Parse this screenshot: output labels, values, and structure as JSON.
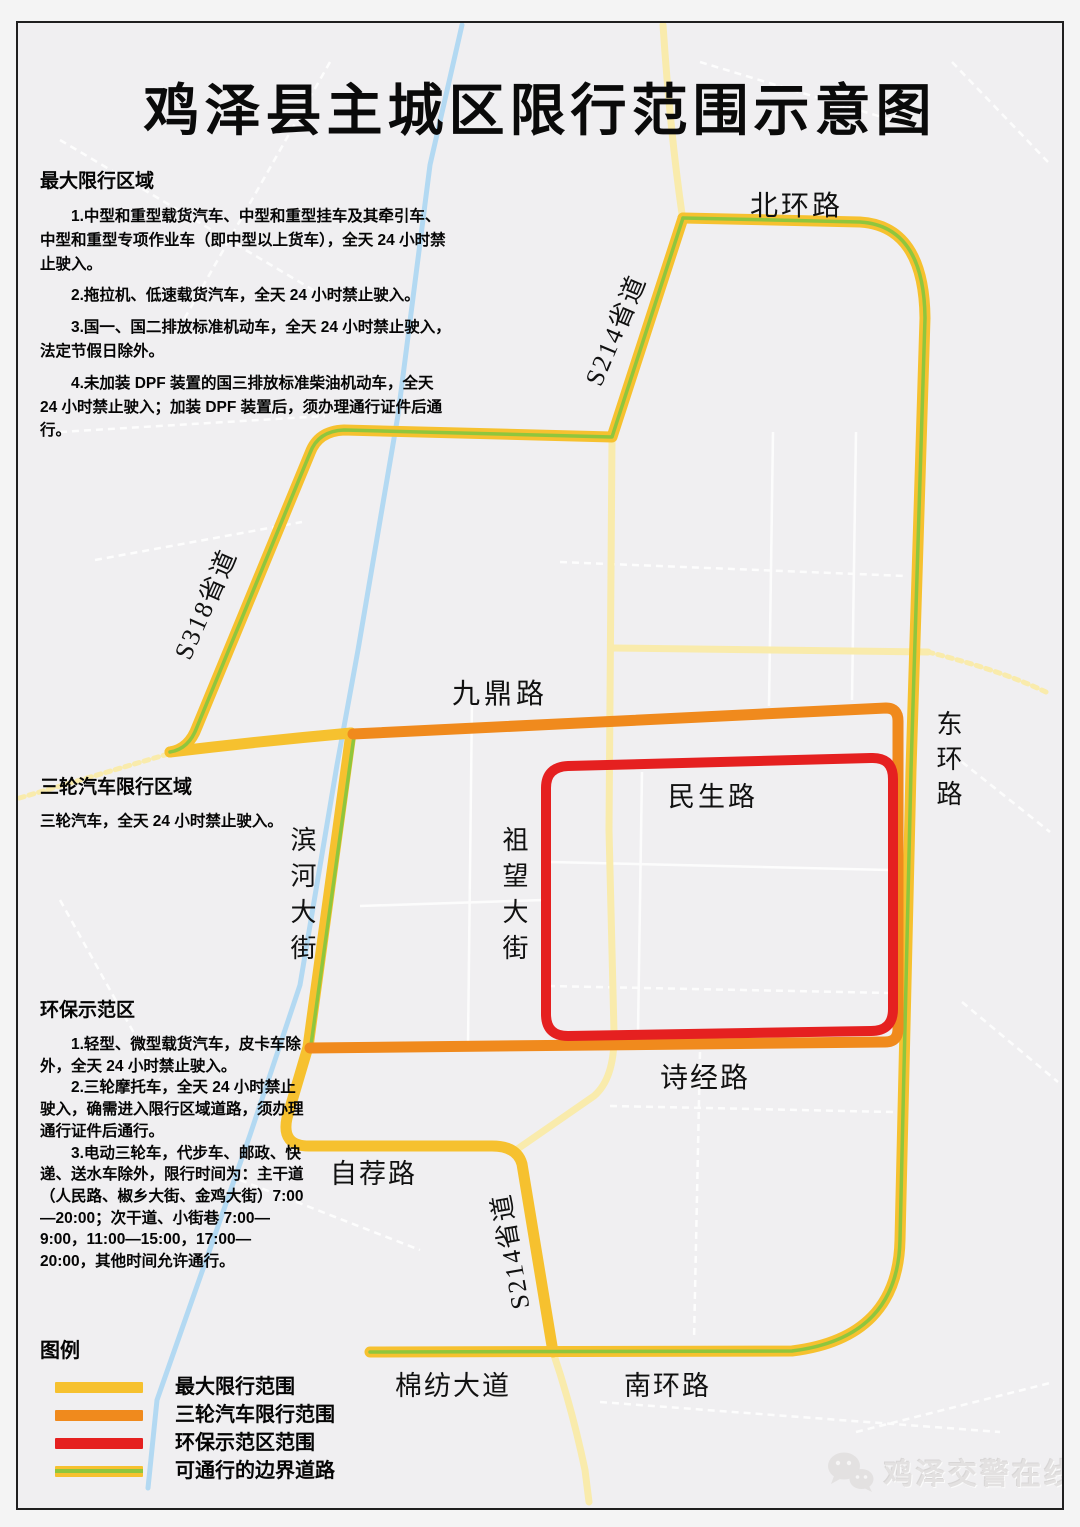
{
  "title": "鸡泽县主城区限行范围示意图",
  "sections": [
    {
      "heading": "最大限行区域",
      "paragraphs": [
        "1.中型和重型载货汽车、中型和重型挂车及其牵引车、中型和重型专项作业车（即中型以上货车），全天 24 小时禁止驶入。",
        "2.拖拉机、低速载货汽车，全天 24 小时禁止驶入。",
        "3.国一、国二排放标准机动车，全天 24 小时禁止驶入，法定节假日除外。",
        "4.未加装 DPF 装置的国三排放标准柴油机动车，全天 24 小时禁止驶入；加装 DPF 装置后，须办理通行证件后通行。"
      ]
    },
    {
      "heading": "三轮汽车限行区域",
      "paragraphs": [
        "三轮汽车，全天 24 小时禁止驶入。"
      ]
    },
    {
      "heading": "环保示范区",
      "paragraphs": [
        "1.轻型、微型载货汽车，皮卡车除外，全天 24 小时禁止驶入。",
        "2.三轮摩托车，全天 24 小时禁止驶入，确需进入限行区域道路，须办理通行证件后通行。",
        "3.电动三轮车，代步车、邮政、快递、送水车除外，限行时间为：主干道（人民路、椒乡大街、金鸡大街）7:00—20:00；次干道、小街巷 7:00—9:00，11:00—15:00，17:00—20:00，其他时间允许通行。"
      ]
    }
  ],
  "legend": {
    "title": "图例",
    "items": [
      {
        "label": "最大限行范围"
      },
      {
        "label": "三轮汽车限行范围"
      },
      {
        "label": "环保示范区范围"
      },
      {
        "label": "可通行的边界道路"
      }
    ]
  },
  "roads": {
    "north_ring": "北环路",
    "s214_north": "S214省道",
    "s318": "S318省道",
    "jiuding": "九鼎路",
    "east_ring": "东环路",
    "minsheng": "民生路",
    "zuwang": "祖望大街",
    "binhe": "滨河大街",
    "shijing": "诗经路",
    "zijian": "自荐路",
    "s214_south": "S214省道",
    "mianfang": "棉纺大道",
    "south_ring": "南环路"
  },
  "watermark": {
    "text": "鸡泽交警在线"
  },
  "colors": {
    "max_restriction": "#F6C12F",
    "tricycle_restriction": "#F08A1D",
    "eco_zone": "#E52020",
    "boundary_green": "#8FC63D",
    "minor_road": "#F9EBAC",
    "river": "#B3D9F2",
    "map_bg": "#F0EFF1",
    "watermark_gray": "#E3E1E1"
  }
}
